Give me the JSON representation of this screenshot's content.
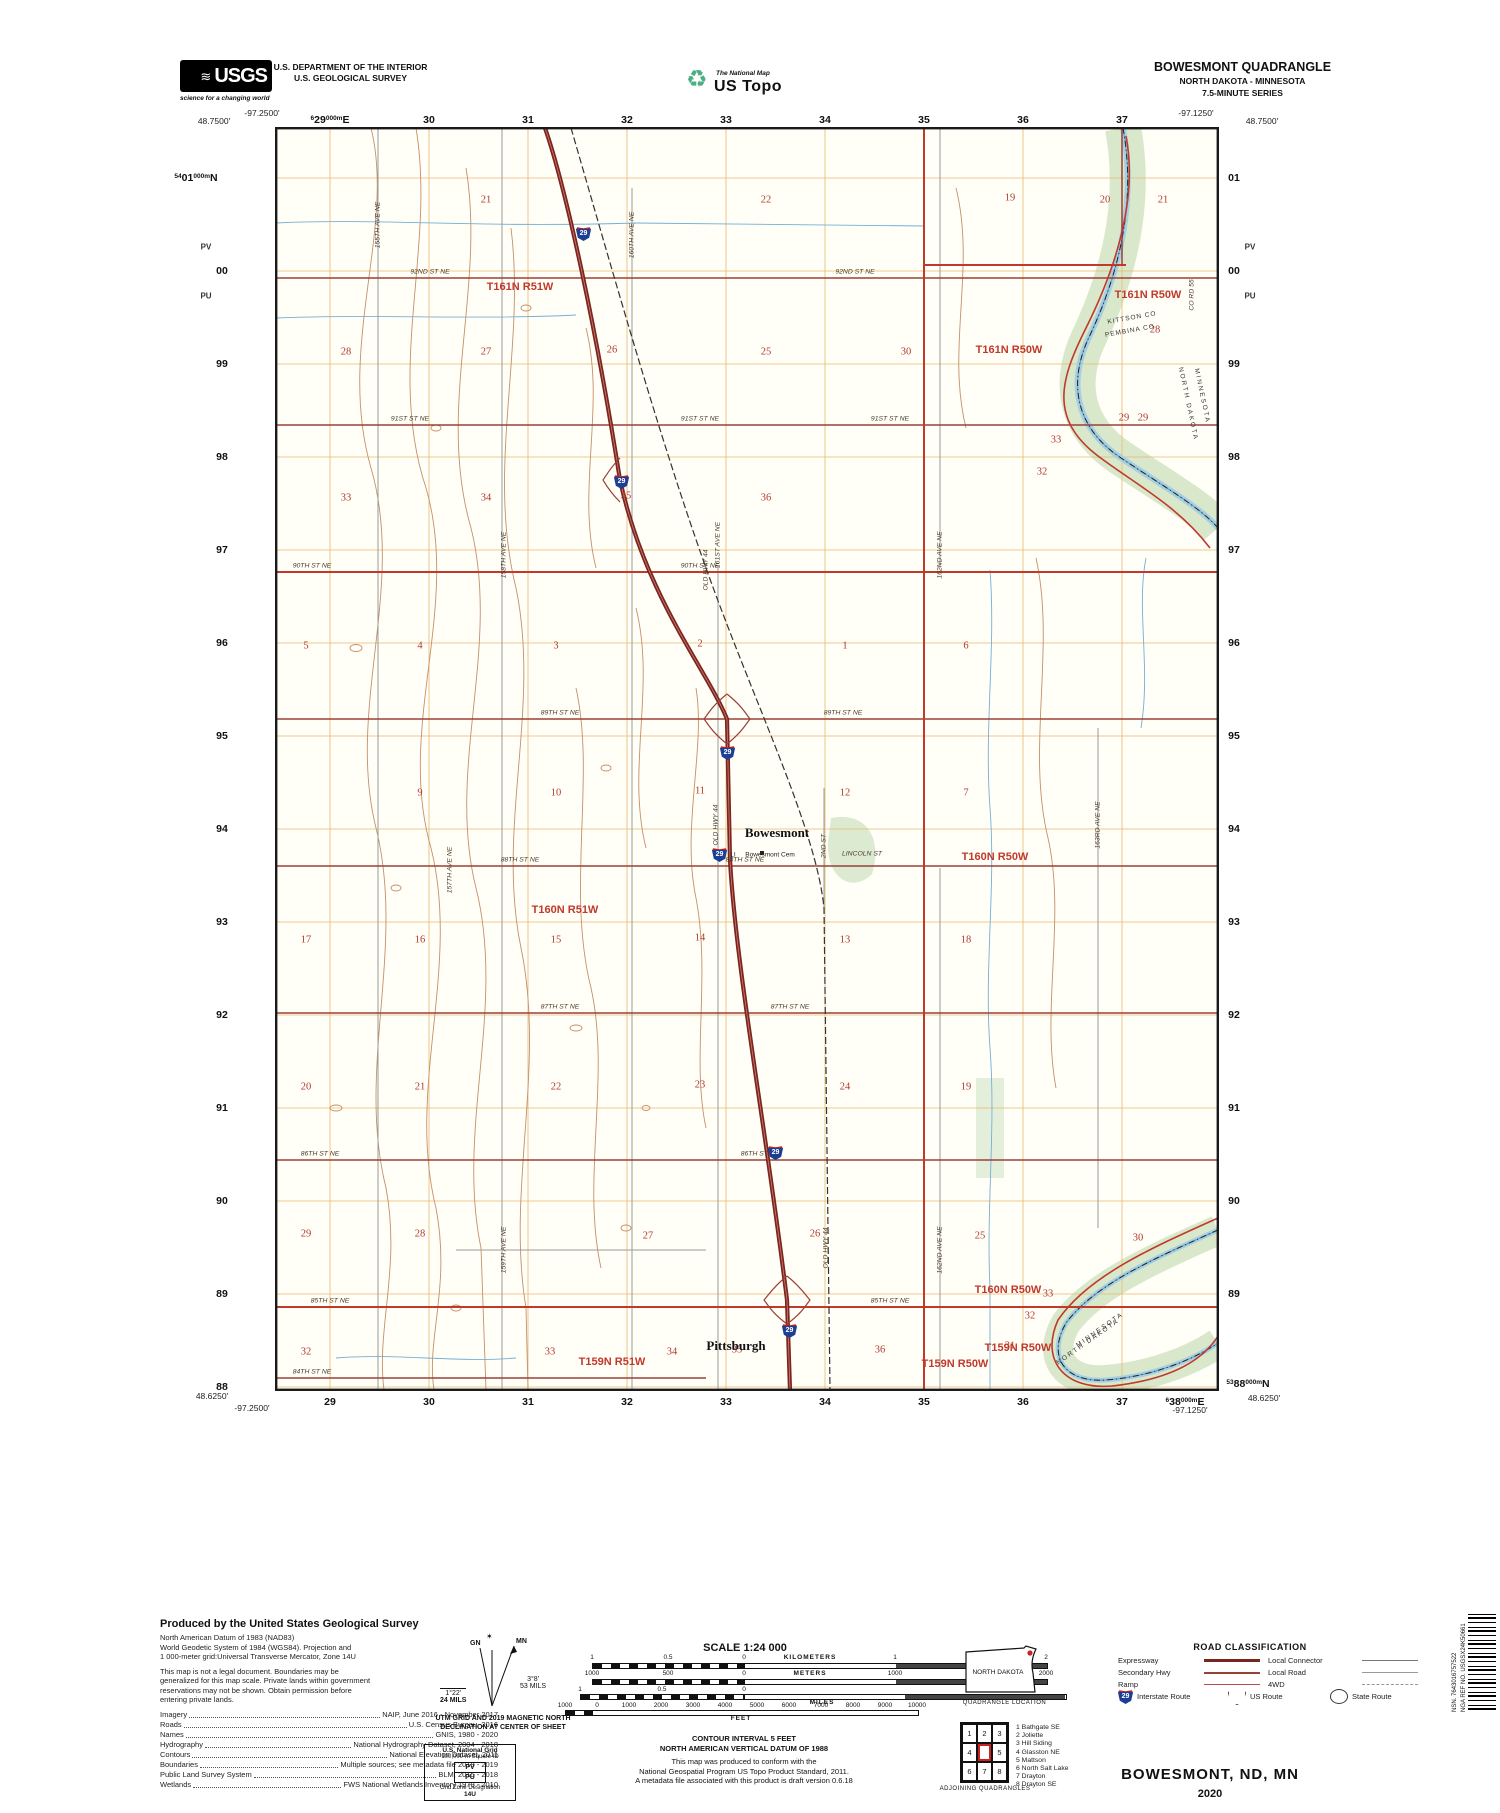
{
  "header": {
    "usgs": "USGS",
    "usgs_wave": "≋",
    "usgs_tagline": "science for a changing world",
    "dept1": "U.S. DEPARTMENT OF THE INTERIOR",
    "dept2": "U.S. GEOLOGICAL SURVEY",
    "natmap_icon": "♻",
    "natmap": "The National Map",
    "ustopo": "US Topo",
    "quad": "BOWESMONT QUADRANGLE",
    "quad_states": "NORTH DAKOTA - MINNESOTA",
    "quad_series": "7.5-MINUTE SERIES"
  },
  "map": {
    "corners": [
      {
        "t": "-97.2500'",
        "x": 262,
        "y": 113,
        "anchor": "l"
      },
      {
        "t": "48.7500'",
        "x": 214,
        "y": 121,
        "anchor": "c"
      },
      {
        "t": "-97.1250'",
        "x": 1196,
        "y": 113,
        "anchor": "c"
      },
      {
        "t": "48.7500'",
        "x": 1262,
        "y": 121,
        "anchor": "c"
      },
      {
        "t": "48.6250'",
        "x": 212,
        "y": 1396,
        "anchor": "c"
      },
      {
        "t": "-97.2500'",
        "x": 252,
        "y": 1408,
        "anchor": "c"
      },
      {
        "t": "-97.1250'",
        "x": 1190,
        "y": 1410,
        "anchor": "c"
      },
      {
        "t": "48.6250'",
        "x": 1264,
        "y": 1398,
        "anchor": "c"
      }
    ],
    "utm": {
      "top_first": {
        "sup": "6",
        "main": "29",
        "sub": "000m",
        "unit": "E"
      },
      "top_rest": [
        "30",
        "31",
        "32",
        "33",
        "34",
        "35",
        "36",
        "37"
      ],
      "bottom_list": [
        "29",
        "30",
        "31",
        "32",
        "33",
        "34",
        "35",
        "36",
        "37"
      ],
      "bottom_last": {
        "sup": "6",
        "main": "38",
        "sub": "000m",
        "unit": "E"
      },
      "left_first": {
        "sup": "54",
        "main": "01",
        "sub": "000m",
        "unit": "N"
      },
      "left_rest": [
        "00",
        "99",
        "98",
        "97",
        "96",
        "95",
        "94",
        "93",
        "92",
        "91",
        "90",
        "89",
        "88"
      ],
      "right_list": [
        "01",
        "00",
        "99",
        "98",
        "97",
        "96",
        "95",
        "94",
        "93",
        "92",
        "91",
        "90",
        "89"
      ],
      "right_last": {
        "sup": "53",
        "main": "88",
        "sub": "000m",
        "unit": "N"
      },
      "sq_north": "PV",
      "sq_south": "PU"
    },
    "shield_number": "29",
    "shields": [
      {
        "x": 583,
        "y": 233
      },
      {
        "x": 621,
        "y": 481
      },
      {
        "x": 727,
        "y": 752
      },
      {
        "x": 719,
        "y": 854
      },
      {
        "x": 775,
        "y": 1152
      },
      {
        "x": 789,
        "y": 1330
      }
    ],
    "townships": [
      {
        "t": "T161N R51W",
        "x": 520,
        "y": 287
      },
      {
        "t": "T161N R50W",
        "x": 1148,
        "y": 295
      },
      {
        "t": "T161N R50W",
        "x": 1009,
        "y": 350
      },
      {
        "t": "T160N R51W",
        "x": 565,
        "y": 910
      },
      {
        "t": "T160N R50W",
        "x": 995,
        "y": 857
      },
      {
        "t": "T160N R50W",
        "x": 1008,
        "y": 1290
      },
      {
        "t": "T159N R51W",
        "x": 612,
        "y": 1362
      },
      {
        "t": "T159N R50W",
        "x": 955,
        "y": 1364
      },
      {
        "t": "T159N R50W",
        "x": 1018,
        "y": 1348
      }
    ],
    "sections": [
      {
        "n": "21",
        "x": 486,
        "y": 200
      },
      {
        "n": "22",
        "x": 766,
        "y": 200
      },
      {
        "n": "19",
        "x": 1010,
        "y": 198
      },
      {
        "n": "20",
        "x": 1105,
        "y": 200
      },
      {
        "n": "21",
        "x": 1163,
        "y": 200
      },
      {
        "n": "28",
        "x": 346,
        "y": 352
      },
      {
        "n": "27",
        "x": 486,
        "y": 352
      },
      {
        "n": "26",
        "x": 612,
        "y": 350
      },
      {
        "n": "25",
        "x": 766,
        "y": 352
      },
      {
        "n": "30",
        "x": 906,
        "y": 352
      },
      {
        "n": "28",
        "x": 1155,
        "y": 330
      },
      {
        "n": "29",
        "x": 1124,
        "y": 418
      },
      {
        "n": "29",
        "x": 1143,
        "y": 418
      },
      {
        "n": "33",
        "x": 346,
        "y": 498
      },
      {
        "n": "34",
        "x": 486,
        "y": 498
      },
      {
        "n": "35",
        "x": 626,
        "y": 496
      },
      {
        "n": "36",
        "x": 766,
        "y": 498
      },
      {
        "n": "33",
        "x": 1056,
        "y": 440
      },
      {
        "n": "32",
        "x": 1042,
        "y": 472
      },
      {
        "n": "5",
        "x": 306,
        "y": 646
      },
      {
        "n": "4",
        "x": 420,
        "y": 646
      },
      {
        "n": "3",
        "x": 556,
        "y": 646
      },
      {
        "n": "2",
        "x": 700,
        "y": 644
      },
      {
        "n": "1",
        "x": 845,
        "y": 646
      },
      {
        "n": "6",
        "x": 966,
        "y": 646
      },
      {
        "n": "9",
        "x": 420,
        "y": 793
      },
      {
        "n": "10",
        "x": 556,
        "y": 793
      },
      {
        "n": "11",
        "x": 700,
        "y": 791
      },
      {
        "n": "12",
        "x": 845,
        "y": 793
      },
      {
        "n": "7",
        "x": 966,
        "y": 793
      },
      {
        "n": "17",
        "x": 306,
        "y": 940
      },
      {
        "n": "16",
        "x": 420,
        "y": 940
      },
      {
        "n": "15",
        "x": 556,
        "y": 940
      },
      {
        "n": "14",
        "x": 700,
        "y": 938
      },
      {
        "n": "13",
        "x": 845,
        "y": 940
      },
      {
        "n": "18",
        "x": 966,
        "y": 940
      },
      {
        "n": "20",
        "x": 306,
        "y": 1087
      },
      {
        "n": "21",
        "x": 420,
        "y": 1087
      },
      {
        "n": "22",
        "x": 556,
        "y": 1087
      },
      {
        "n": "23",
        "x": 700,
        "y": 1085
      },
      {
        "n": "24",
        "x": 845,
        "y": 1087
      },
      {
        "n": "19",
        "x": 966,
        "y": 1087
      },
      {
        "n": "29",
        "x": 306,
        "y": 1234
      },
      {
        "n": "28",
        "x": 420,
        "y": 1234
      },
      {
        "n": "27",
        "x": 648,
        "y": 1236
      },
      {
        "n": "26",
        "x": 815,
        "y": 1234
      },
      {
        "n": "25",
        "x": 980,
        "y": 1236
      },
      {
        "n": "30",
        "x": 1138,
        "y": 1238
      },
      {
        "n": "32",
        "x": 306,
        "y": 1352
      },
      {
        "n": "33",
        "x": 550,
        "y": 1352
      },
      {
        "n": "34",
        "x": 672,
        "y": 1352
      },
      {
        "n": "35",
        "x": 737,
        "y": 1350
      },
      {
        "n": "36",
        "x": 880,
        "y": 1350
      },
      {
        "n": "31",
        "x": 1010,
        "y": 1346
      },
      {
        "n": "33",
        "x": 1048,
        "y": 1294
      },
      {
        "n": "32",
        "x": 1030,
        "y": 1316
      }
    ],
    "towns": [
      {
        "t": "Bowesmont",
        "x": 777,
        "y": 833
      },
      {
        "t": "Pittsburgh",
        "x": 736,
        "y": 1346
      }
    ],
    "labels": [
      {
        "t": "92ND ST NE",
        "x": 430,
        "y": 272,
        "c": "s"
      },
      {
        "t": "92ND ST NE",
        "x": 855,
        "y": 272,
        "c": "s"
      },
      {
        "t": "91ST ST NE",
        "x": 410,
        "y": 419,
        "c": "s"
      },
      {
        "t": "91ST ST NE",
        "x": 700,
        "y": 419,
        "c": "s"
      },
      {
        "t": "91ST ST NE",
        "x": 890,
        "y": 419,
        "c": "s"
      },
      {
        "t": "90TH ST NE",
        "x": 312,
        "y": 566,
        "c": "s"
      },
      {
        "t": "90TH ST NE",
        "x": 700,
        "y": 566,
        "c": "s"
      },
      {
        "t": "89TH ST NE",
        "x": 560,
        "y": 713,
        "c": "s"
      },
      {
        "t": "89TH ST NE",
        "x": 843,
        "y": 713,
        "c": "s"
      },
      {
        "t": "88TH ST NE",
        "x": 520,
        "y": 860,
        "c": "s"
      },
      {
        "t": "88TH ST NE",
        "x": 745,
        "y": 860,
        "c": "s"
      },
      {
        "t": "87TH ST NE",
        "x": 560,
        "y": 1007,
        "c": "s"
      },
      {
        "t": "87TH ST NE",
        "x": 790,
        "y": 1007,
        "c": "s"
      },
      {
        "t": "86TH ST NE",
        "x": 320,
        "y": 1154,
        "c": "s"
      },
      {
        "t": "86TH ST NE",
        "x": 760,
        "y": 1154,
        "c": "s"
      },
      {
        "t": "85TH ST NE",
        "x": 330,
        "y": 1301,
        "c": "s"
      },
      {
        "t": "85TH ST NE",
        "x": 890,
        "y": 1301,
        "c": "s"
      },
      {
        "t": "84TH ST NE",
        "x": 312,
        "y": 1372,
        "c": "s"
      },
      {
        "t": "LINCOLN ST",
        "x": 862,
        "y": 854,
        "c": "s"
      },
      {
        "t": "155TH AVE NE",
        "x": 378,
        "y": 225,
        "c": "s",
        "r": -90
      },
      {
        "t": "157TH AVE NE",
        "x": 450,
        "y": 870,
        "c": "s",
        "r": -90
      },
      {
        "t": "158TH AVE NE",
        "x": 504,
        "y": 555,
        "c": "s",
        "r": -90
      },
      {
        "t": "159TH AVE NE",
        "x": 504,
        "y": 1250,
        "c": "s",
        "r": -90
      },
      {
        "t": "160TH AVE NE",
        "x": 632,
        "y": 235,
        "c": "s",
        "r": -90
      },
      {
        "t": "161ST AVE NE",
        "x": 718,
        "y": 545,
        "c": "s",
        "r": -90
      },
      {
        "t": "162ND AVE NE",
        "x": 940,
        "y": 555,
        "c": "s",
        "r": -90
      },
      {
        "t": "162ND AVE NE",
        "x": 940,
        "y": 1250,
        "c": "s",
        "r": -90
      },
      {
        "t": "163RD AVE NE",
        "x": 1098,
        "y": 825,
        "c": "s",
        "r": -90
      },
      {
        "t": "OLD HWY 44",
        "x": 706,
        "y": 570,
        "c": "s",
        "r": -90
      },
      {
        "t": "OLD HWY 44",
        "x": 716,
        "y": 825,
        "c": "s",
        "r": -90
      },
      {
        "t": "OLD HWY 44",
        "x": 826,
        "y": 1248,
        "c": "s",
        "r": -90
      },
      {
        "t": "2ND ST",
        "x": 824,
        "y": 846,
        "c": "s",
        "r": -90
      },
      {
        "t": "CO RD 55",
        "x": 1192,
        "y": 295,
        "c": "s",
        "r": -90
      },
      {
        "t": "Bowesmont Cem",
        "x": 770,
        "y": 855,
        "c": "cem"
      },
      {
        "t": "LI",
        "x": 733,
        "y": 855,
        "c": "cem"
      },
      {
        "t": "KITTSON CO",
        "x": 1132,
        "y": 318,
        "c": "cnty",
        "r": -10
      },
      {
        "t": "PEMBINA CO",
        "x": 1130,
        "y": 331,
        "c": "cnty",
        "r": -10
      },
      {
        "t": "MINNESOTA",
        "x": 1202,
        "y": 396,
        "c": "state",
        "r": 78
      },
      {
        "t": "NORTH DAKOTA",
        "x": 1188,
        "y": 404,
        "c": "state",
        "r": 78
      },
      {
        "t": "MINNESOTA",
        "x": 1100,
        "y": 1330,
        "c": "state",
        "r": -35
      },
      {
        "t": "NORTH DAKOTA",
        "x": 1088,
        "y": 1342,
        "c": "state",
        "r": -35
      }
    ]
  },
  "footer": {
    "credits_title": "Produced by the United States Geological Survey",
    "credits_lines": [
      "North American Datum of 1983 (NAD83)",
      "World Geodetic System of 1984 (WGS84).  Projection and",
      "1 000-meter grid:Universal Transverse Mercator, Zone 14U",
      "",
      "This map is not a legal document. Boundaries may be",
      "generalized for this map scale. Private lands within government",
      "reservations may not be shown. Obtain permission before",
      "entering private lands."
    ],
    "sources": [
      [
        "Imagery",
        "NAIP, June 2016 - November 2017"
      ],
      [
        "Roads",
        "U.S. Census Bureau, 2016"
      ],
      [
        "Names",
        "GNIS, 1980 - 2020"
      ],
      [
        "Hydrography",
        "National Hydrography Dataset, 2004 - 2018"
      ],
      [
        "Contours",
        "National Elevation Dataset, 2011"
      ],
      [
        "Boundaries",
        "Multiple sources; see metadata file 2018 - 2019"
      ],
      [
        "Public Land Survey System",
        "BLM, 2015 - 2018"
      ],
      [
        "Wetlands",
        "FWS National Wetlands Inventory 1979 - 2010"
      ]
    ],
    "declination": {
      "mn": "MN",
      "gn": "GN",
      "star": "✶",
      "gn_deg": "1°22'",
      "gn_mils": "24 MILS",
      "mn_deg": "3°8'",
      "mn_mils": "53 MILS",
      "caption1": "UTM GRID AND 2019 MAGNETIC NORTH",
      "caption2": "DECLINATION AT CENTER OF SHEET"
    },
    "usng": {
      "title": "U.S. National Grid",
      "sub": "100,000-m Square ID",
      "sq1": "PV",
      "sq2": "PU",
      "gzd_label": "Grid Zone Designation",
      "gzd": "14U"
    },
    "scale_title": "SCALE 1:24 000",
    "bars": {
      "km_ticks": [
        "1",
        "0.5",
        "0",
        "1",
        "2"
      ],
      "km_unit": "KILOMETERS",
      "m_ticks": [
        "1000",
        "500",
        "0",
        "1000",
        "2000"
      ],
      "m_unit": "METERS",
      "mi_ticks": [
        "1",
        "0.5",
        "0"
      ],
      "mi_unit": "MILES",
      "ft_ticks": [
        "1000",
        "0",
        "1000",
        "2000",
        "3000",
        "4000",
        "5000",
        "6000",
        "7000",
        "8000",
        "9000",
        "10000"
      ],
      "ft_unit": "FEET"
    },
    "contour_note1": "CONTOUR INTERVAL 5 FEET",
    "contour_note2": "NORTH AMERICAN VERTICAL DATUM OF 1988",
    "standard_note1": "This map was produced to conform with the",
    "standard_note2": "National Geospatial Program US Topo Product Standard, 2011.",
    "standard_note3": "A metadata file associated with this product is draft version 0.6.18",
    "state_name": "NORTH DAKOTA",
    "location_caption": "QUADRANGLE LOCATION",
    "adjoining_cells": [
      "1",
      "2",
      "3",
      "4",
      "",
      "5",
      "6",
      "7",
      "8"
    ],
    "adjoining_caption": "ADJOINING QUADRANGLES",
    "adjoining_list": [
      "1 Bathgate SE",
      "2 Joliette",
      "3 Hill Siding",
      "4 Glasston NE",
      "5 Mattson",
      "6 North Salt Lake",
      "7 Drayton",
      "8 Drayton SE"
    ],
    "roadclass": {
      "title": "ROAD CLASSIFICATION",
      "left": [
        "Expressway",
        "Secondary Hwy",
        "Ramp"
      ],
      "right": [
        "Local Connector",
        "Local Road",
        "4WD"
      ],
      "interstate": "Interstate Route",
      "us": "US Route",
      "state": "State Route"
    },
    "map_title": "BOWESMONT,  ND, MN",
    "year": "2020",
    "nsn": "NSN. 7643016757522",
    "nga": "NGA REF NO. USGSX24K50661"
  }
}
